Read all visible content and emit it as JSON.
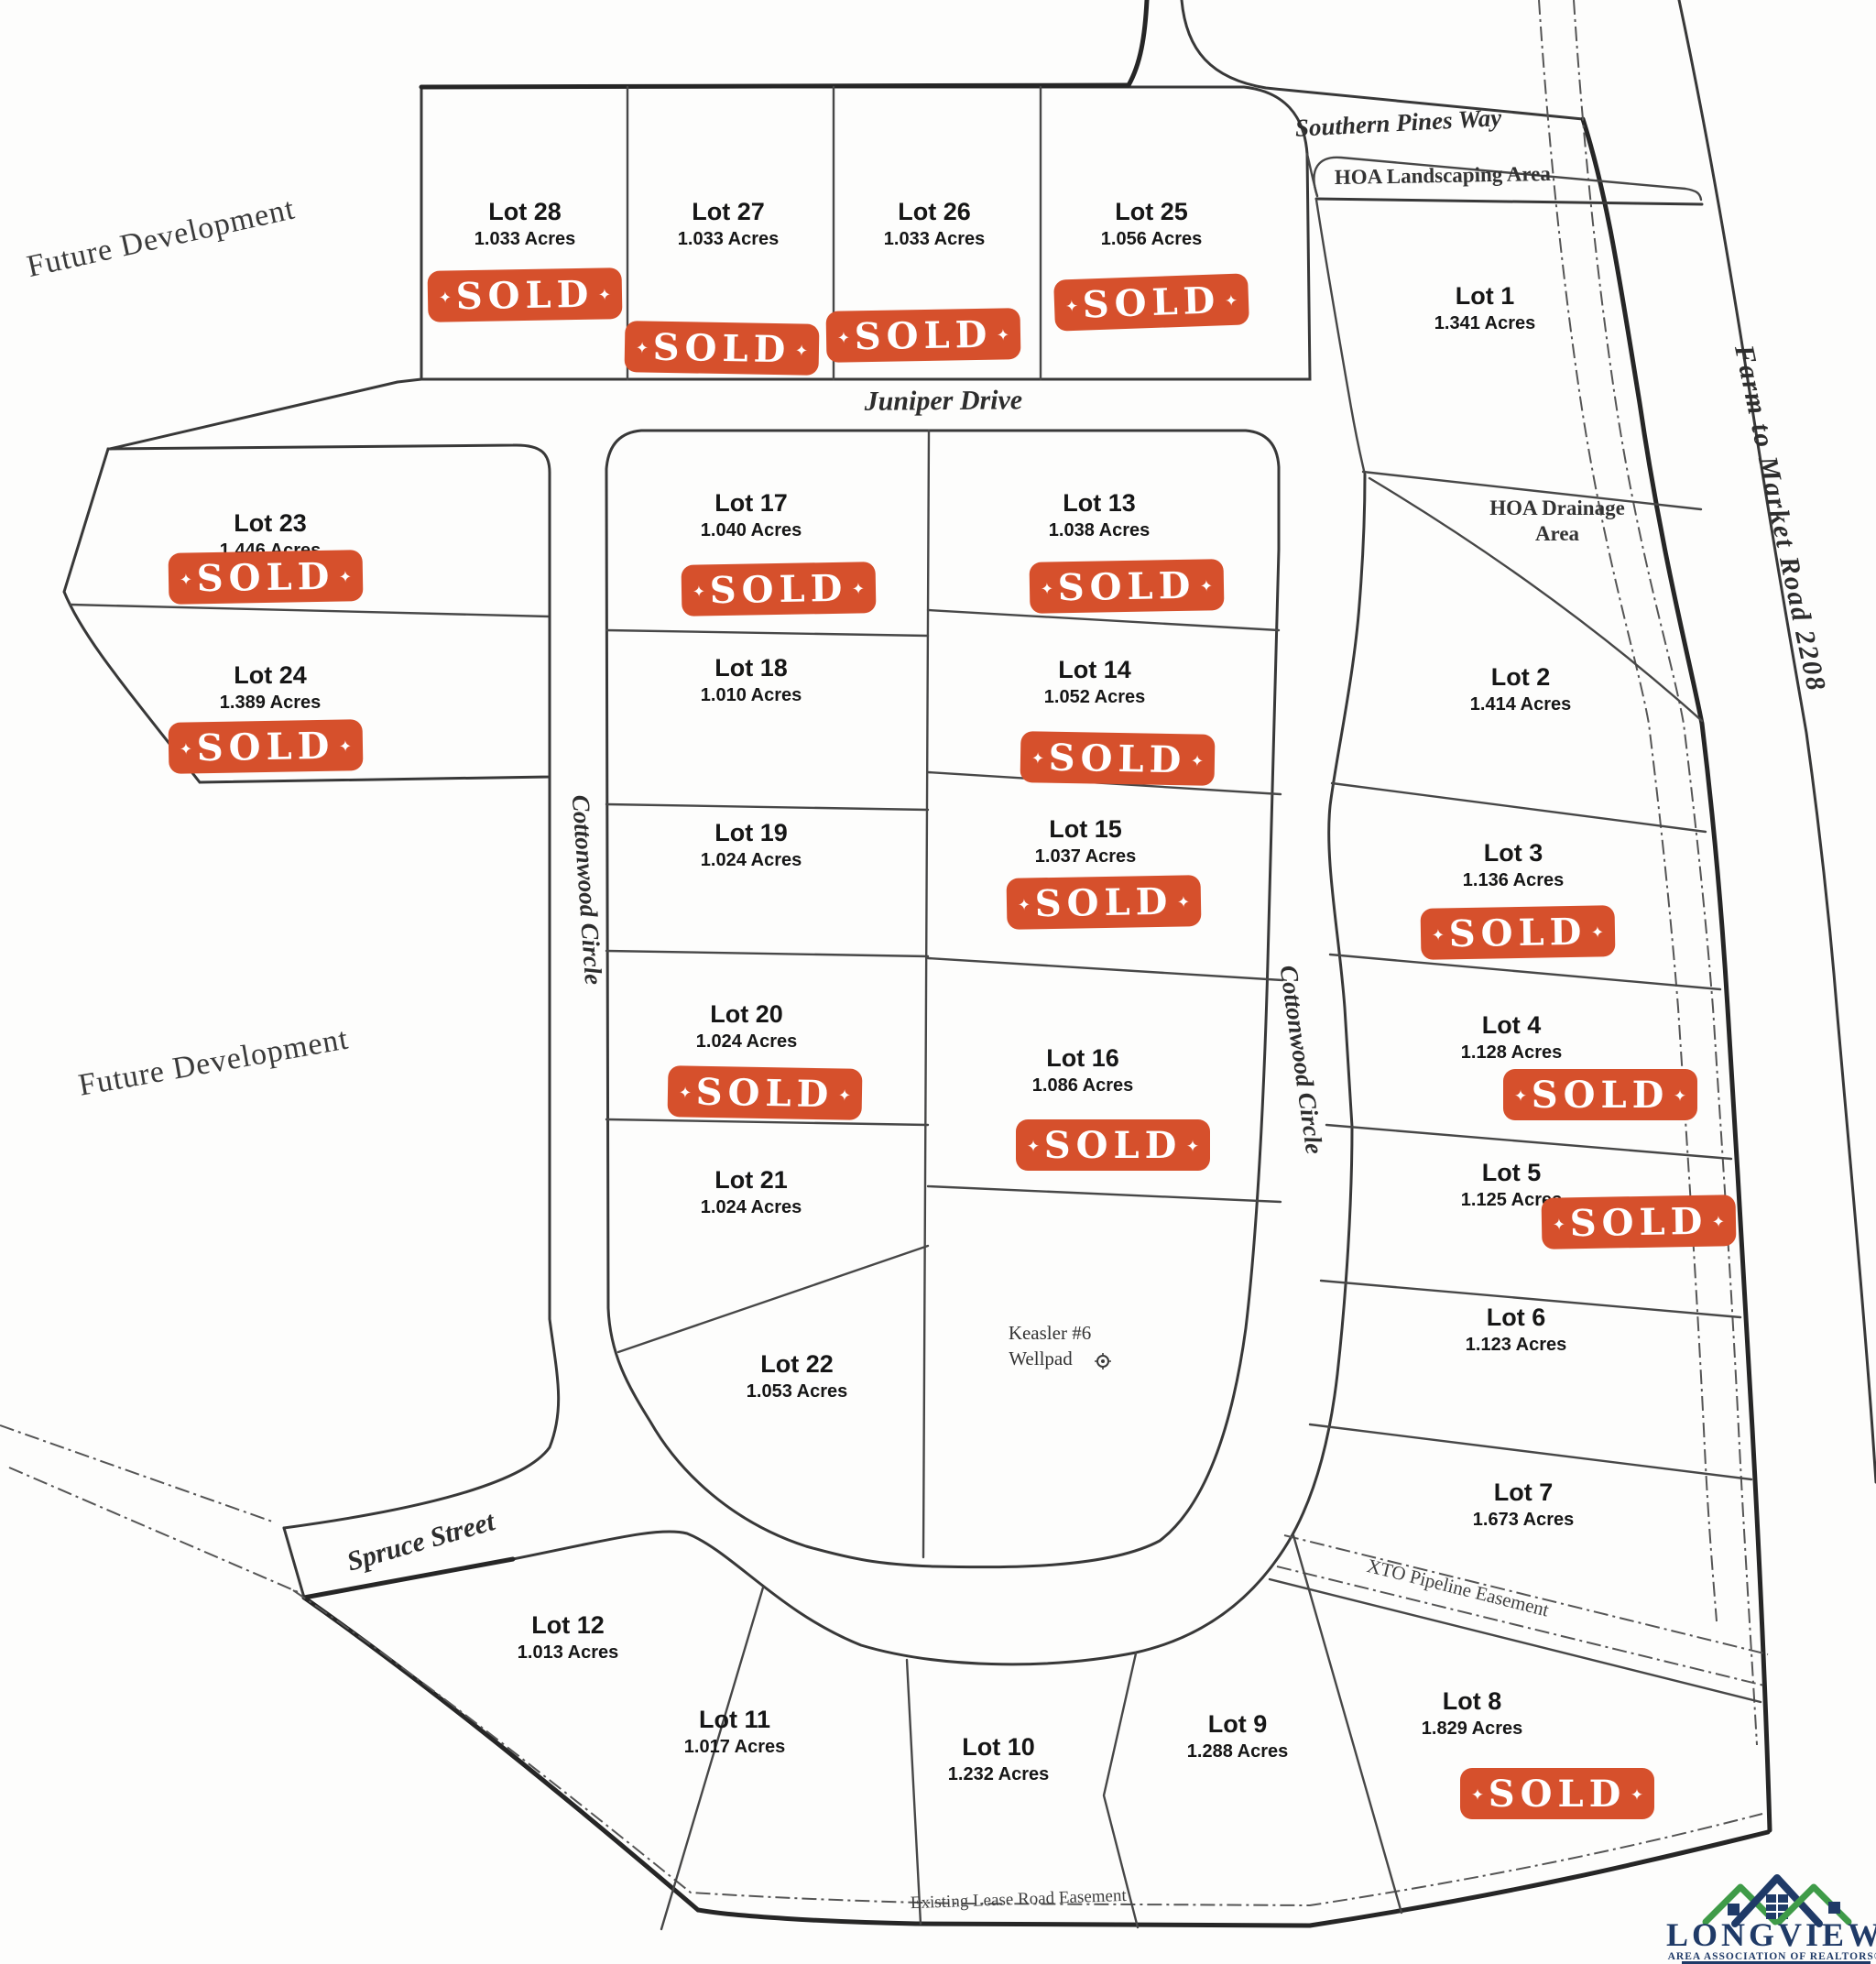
{
  "stamp": {
    "text": "SOLD",
    "star": "✦",
    "color": "#d6502c"
  },
  "lots": [
    {
      "name": "Lot 1",
      "acres": "1.341 Acres",
      "sold": false
    },
    {
      "name": "Lot 2",
      "acres": "1.414 Acres",
      "sold": false
    },
    {
      "name": "Lot 3",
      "acres": "1.136 Acres",
      "sold": true
    },
    {
      "name": "Lot 4",
      "acres": "1.128 Acres",
      "sold": true
    },
    {
      "name": "Lot 5",
      "acres": "1.125 Acres",
      "sold": true
    },
    {
      "name": "Lot 6",
      "acres": "1.123 Acres",
      "sold": false
    },
    {
      "name": "Lot 7",
      "acres": "1.673 Acres",
      "sold": false
    },
    {
      "name": "Lot 8",
      "acres": "1.829 Acres",
      "sold": true
    },
    {
      "name": "Lot 9",
      "acres": "1.288 Acres",
      "sold": false
    },
    {
      "name": "Lot 10",
      "acres": "1.232 Acres",
      "sold": false
    },
    {
      "name": "Lot 11",
      "acres": "1.017 Acres",
      "sold": false
    },
    {
      "name": "Lot 12",
      "acres": "1.013 Acres",
      "sold": false
    },
    {
      "name": "Lot 13",
      "acres": "1.038 Acres",
      "sold": true
    },
    {
      "name": "Lot 14",
      "acres": "1.052 Acres",
      "sold": true
    },
    {
      "name": "Lot 15",
      "acres": "1.037 Acres",
      "sold": true
    },
    {
      "name": "Lot 16",
      "acres": "1.086 Acres",
      "sold": true
    },
    {
      "name": "Lot 17",
      "acres": "1.040 Acres",
      "sold": true
    },
    {
      "name": "Lot 18",
      "acres": "1.010 Acres",
      "sold": false
    },
    {
      "name": "Lot 19",
      "acres": "1.024 Acres",
      "sold": false
    },
    {
      "name": "Lot 20",
      "acres": "1.024 Acres",
      "sold": true
    },
    {
      "name": "Lot 21",
      "acres": "1.024 Acres",
      "sold": false
    },
    {
      "name": "Lot 22",
      "acres": "1.053 Acres",
      "sold": false
    },
    {
      "name": "Lot 23",
      "acres": "1.446 Acres",
      "sold": true
    },
    {
      "name": "Lot 24",
      "acres": "1.389 Acres",
      "sold": true
    },
    {
      "name": "Lot 25",
      "acres": "1.056 Acres",
      "sold": true
    },
    {
      "name": "Lot 26",
      "acres": "1.033 Acres",
      "sold": true
    },
    {
      "name": "Lot 27",
      "acres": "1.033 Acres",
      "sold": true
    },
    {
      "name": "Lot 28",
      "acres": "1.033 Acres",
      "sold": true
    }
  ],
  "roads": {
    "juniper": "Juniper Drive",
    "southern_pines": "Southern Pines Way",
    "cottonwood_west": "Cottonwood Circle",
    "cottonwood_east": "Cottonwood Circle",
    "spruce": "Spruce Street",
    "farm_to_market": "Farm to Market Road 2208"
  },
  "areas": {
    "future_dev_top": "Future Development",
    "future_dev_mid": "Future Development",
    "hoa_landscaping": "HOA Landscaping Area",
    "hoa_drainage_line1": "HOA Drainage",
    "hoa_drainage_line2": "Area",
    "xto_easement": "XTO Pipeline Easement",
    "lease_road": "Existing Lease Road Easement",
    "wellpad_line1": "Keasler #6",
    "wellpad_line2": "Wellpad"
  },
  "logo": {
    "title": "LONGVIEW",
    "subtitle": "AREA ASSOCIATION OF REALTORS®",
    "navy": "#1f3a67",
    "green": "#3f9b48"
  }
}
